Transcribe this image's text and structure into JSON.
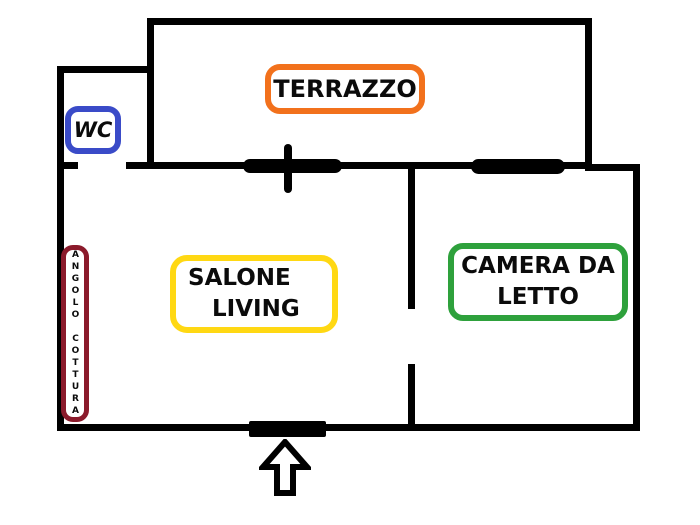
{
  "floorplan": {
    "type": "apartment-floor-plan",
    "background_color": "#ffffff",
    "wall_color": "#000000",
    "rooms": {
      "terrazzo": {
        "label": "TERRAZZO",
        "accent_color": "#f2711c"
      },
      "wc": {
        "label": "WC",
        "accent_color": "#3a4bc8"
      },
      "salone": {
        "lines": [
          "SALONE",
          "LIVING"
        ],
        "accent_color": "#ffd813"
      },
      "camera": {
        "lines": [
          "CAMERA DA",
          "LETTO"
        ],
        "accent_color": "#2ea13c"
      },
      "angolo_cottura": {
        "label": "ANGOLO COTTURA",
        "accent_color": "#8b1a2b"
      }
    },
    "symbols": {
      "entrance_arrow_direction": "up",
      "doors": [
        "wc-opening",
        "terrace-french-door",
        "bedroom-opening",
        "entrance-door"
      ],
      "windows": [
        "terrace-window"
      ]
    }
  }
}
